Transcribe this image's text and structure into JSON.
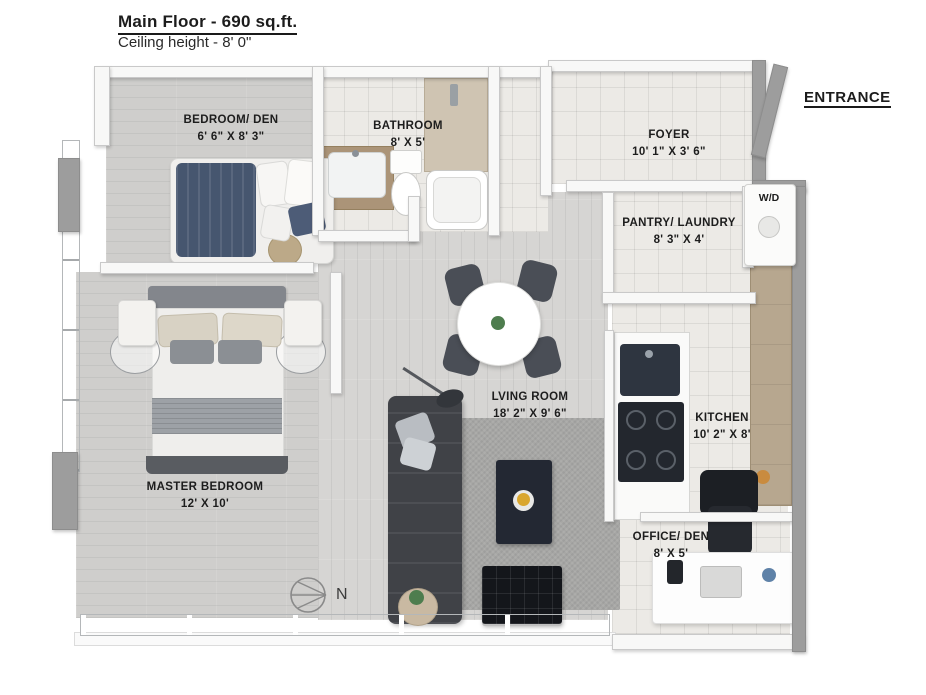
{
  "header": {
    "title": "Main Floor - 690 sq.ft.",
    "subtitle": "Ceiling height - 8' 0\""
  },
  "entrance": {
    "label": "ENTRANCE"
  },
  "rooms": [
    {
      "id": "bedroom-den",
      "name": "BEDROOM/ DEN",
      "dims": "6' 6\" X 8' 3\""
    },
    {
      "id": "bathroom",
      "name": "BATHROOM",
      "dims": "8' X 5'"
    },
    {
      "id": "foyer",
      "name": "FOYER",
      "dims": "10' 1\" X 3' 6\""
    },
    {
      "id": "pantry-laundry",
      "name": "PANTRY/ LAUNDRY",
      "dims": "8' 3\" X 4'"
    },
    {
      "id": "living-room",
      "name": "LVING ROOM",
      "dims": "18' 2\" X 9' 6\""
    },
    {
      "id": "kitchen",
      "name": "KITCHEN",
      "dims": "10' 2\" X 8'"
    },
    {
      "id": "master-bedroom",
      "name": "MASTER BEDROOM",
      "dims": "12' X 10'"
    },
    {
      "id": "office-den",
      "name": "OFFICE/ DEN",
      "dims": "8' X 5'"
    }
  ],
  "appliances": {
    "washer_dryer": "W/D"
  },
  "compass": {
    "label": "N"
  },
  "colors": {
    "wall_gray": "#9d9d9d",
    "blanket_navy": "#46566f",
    "cabinet_wood": "#b7a78f",
    "sofa_charcoal": "#404247",
    "accent_yellow": "#d9a62e"
  }
}
